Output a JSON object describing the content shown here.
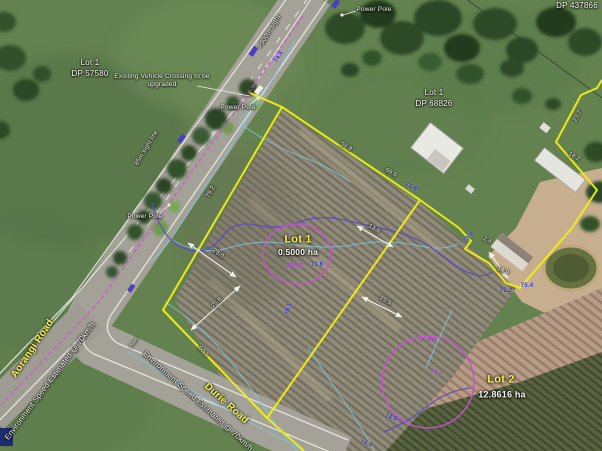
{
  "map": {
    "lots": {
      "lot1_dp57580": {
        "line1": "Lot 1",
        "line2": "DP 57580"
      },
      "lot1_dp68826": {
        "line1": "Lot 1",
        "line2": "DP 68826"
      },
      "dp437866": "DP 437866",
      "lot1_main": {
        "title": "Lot 1",
        "area": "0.5000 ha",
        "circle": "20mØ"
      },
      "lot2": {
        "title": "Lot 2",
        "area": "12.8616 ha",
        "circle": "20mØ"
      }
    },
    "roads": {
      "aorangi": "Aorangi Road",
      "durie": "Durie Road",
      "speed_note": "Environment Speed Estimated @ 70km/h"
    },
    "notes": {
      "crossing_line1": "Existing Vehicle Crossing to be",
      "crossing_line2": "upgraded",
      "power_pole": "Power Pole",
      "sight_300": ">300m sight",
      "sight_85": "85m sight line",
      "drain": "Drain"
    },
    "measurements": {
      "m78_2": "78.2",
      "m59_8": "59.8",
      "m69_6": "69.6",
      "m25_7": "25.7",
      "m18_2": "18.2",
      "m60_1": "60.1",
      "m25_0": "25.0",
      "m25_6": "25.6",
      "m13_6": "13.6",
      "m25_3": "25.3",
      "m14_9": "14.9",
      "m2_3": "2.3"
    },
    "contours": {
      "c73_6": "73.6",
      "c73_9": "73.9",
      "c75_4": "75.4",
      "c75_2": "75.2",
      "c74_6": "74.6",
      "c74_4": "74.4",
      "c74_9": "74.9",
      "c71_6": "71.6",
      "c78_1": "78.1",
      "c74_6_road": "74.6"
    },
    "colors": {
      "boundary_yellow": "#f2ef12",
      "contour_cyan": "#7cc6de",
      "contour_purple": "#5b49c8",
      "survey_magenta": "#d64fd6",
      "label_blue": "#2f2fd2",
      "road_label_yellow": "#f8f545"
    }
  }
}
